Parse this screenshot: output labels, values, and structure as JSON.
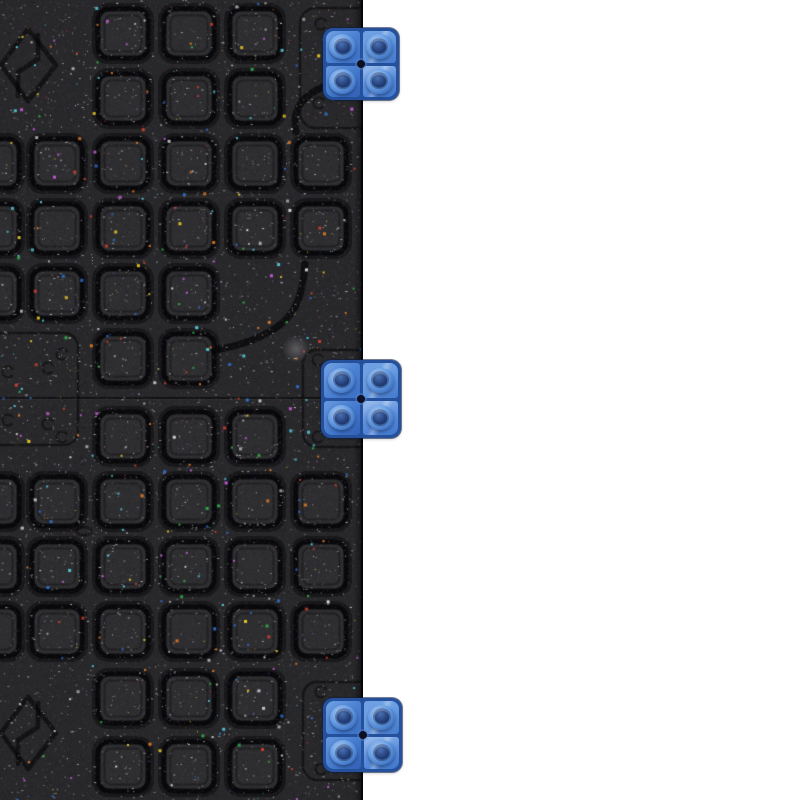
{
  "scene": {
    "subject": "Two black recycled-rubber interlocking floor tiles with studded square surface, joined at a horizontal seam, with three blue plastic connector clips mounted on the exposed right edge",
    "background_color": "#ffffff",
    "width": 800,
    "height": 800
  },
  "tile": {
    "x": 0,
    "y": 0,
    "width": 363,
    "height": 800,
    "base_color": "#28282b",
    "face_color": "#2e2e31",
    "groove_color": "#08080a",
    "edge_color": "#050507",
    "seam_y": 398,
    "grid": {
      "square_w": 48,
      "square_h": 47,
      "radius": 10,
      "col_lefts": [
        -30,
        33,
        99,
        165,
        231,
        297
      ],
      "row_tops_top_tile": [
        10,
        75,
        140,
        205,
        270,
        335
      ],
      "row_tops_bottom_tile": [
        413,
        478,
        543,
        608,
        675,
        743
      ]
    },
    "skip_zones": [
      [
        -40,
        20,
        104,
        92
      ],
      [
        -40,
        688,
        104,
        94
      ],
      [
        -40,
        331,
        122,
        116
      ],
      [
        299,
        4,
        66,
        122
      ],
      [
        301,
        346,
        64,
        104
      ],
      [
        301,
        676,
        64,
        108
      ],
      [
        292,
        70,
        66,
        64
      ],
      [
        278,
        253,
        90,
        99
      ]
    ],
    "plates": [
      {
        "x": 300,
        "y": 8,
        "w": 76,
        "h": 120,
        "r": 16,
        "circles": [
          [
            321,
            24
          ],
          [
            319,
            103
          ]
        ]
      },
      {
        "x": 303,
        "y": 350,
        "w": 74,
        "h": 97,
        "r": 14,
        "circles": [
          [
            318,
            360
          ],
          [
            318,
            437
          ]
        ]
      },
      {
        "x": 303,
        "y": 682,
        "w": 74,
        "h": 98,
        "r": 14,
        "circles": [
          [
            321,
            692
          ],
          [
            321,
            769
          ]
        ]
      },
      {
        "x": -16,
        "y": 333,
        "w": 94,
        "h": 112,
        "r": 14,
        "circles": [
          [
            8,
            372
          ],
          [
            48,
            368
          ],
          [
            62,
            354
          ],
          [
            8,
            420
          ],
          [
            48,
            424
          ],
          [
            62,
            437
          ]
        ]
      }
    ],
    "logos": [
      {
        "cx": 28,
        "cy": 65
      },
      {
        "cx": 28,
        "cy": 733
      }
    ],
    "curves": [
      "M346,80 C322,85 306,94 299,106 C295,113 294,122 296,132",
      "M305,264 C303,294 296,312 281,324 C263,338 240,346 214,350"
    ],
    "bridge_marks": [
      [
        84,
        531
      ]
    ],
    "smudge": {
      "x": 296,
      "y": 349,
      "r": 14
    },
    "grain_count": 42000,
    "micro_speck_count": 2600,
    "fleck_count": 650,
    "fleck_colors": [
      "#d6d6d6",
      "#a8a8a8",
      "#c9402e",
      "#2f6fd0",
      "#e8c829",
      "#35a84a",
      "#e07a25",
      "#55c5d5",
      "#c05ad0"
    ]
  },
  "clips": {
    "count": 3,
    "studs_per_clip": 4,
    "base_color": "#4a80d2",
    "groove_color": "#24509c",
    "stud_ring_color": "#6aa2e8",
    "stud_core_color": "#1d3a70",
    "center_hole_color": "#0d1020",
    "items": [
      {
        "id": "top",
        "x": 323,
        "y": 28,
        "w": 76,
        "h": 72
      },
      {
        "id": "middle",
        "x": 321,
        "y": 360,
        "w": 80,
        "h": 78
      },
      {
        "id": "bottom",
        "x": 323,
        "y": 698,
        "w": 79,
        "h": 74
      }
    ]
  }
}
